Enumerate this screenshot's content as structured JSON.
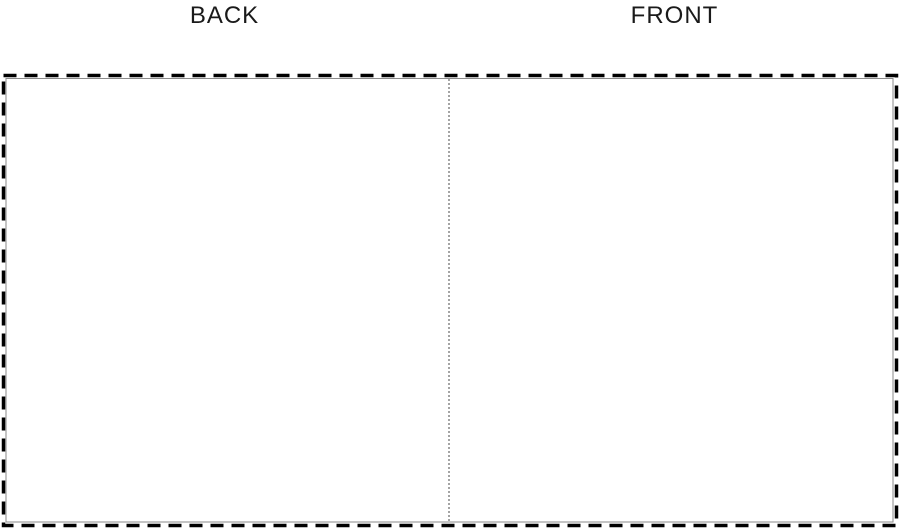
{
  "page": {
    "background_color": "#ffffff",
    "description_labels": {
      "back": "BACK",
      "front": "FRONT"
    }
  },
  "template": {
    "outer_border_color": "#000000",
    "inner_line_color": "#8a8a8a",
    "divider_color": "#4a4a4a"
  }
}
